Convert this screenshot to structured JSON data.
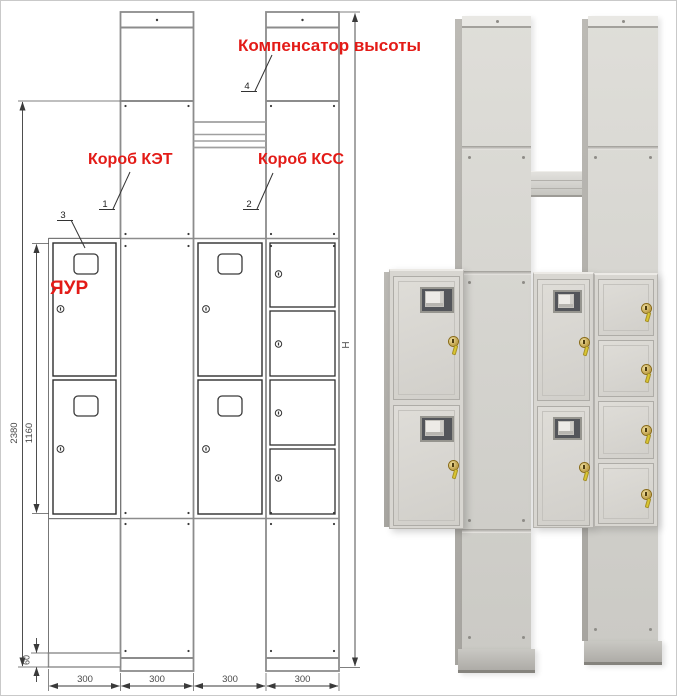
{
  "drawing": {
    "red_labels": {
      "kompensator": "Компенсатор высоты",
      "korob_ket": "Короб КЭТ",
      "korob_kss": "Короб КСС",
      "yaur": "ЯУР"
    },
    "callouts": {
      "ket": "1",
      "kss": "2",
      "yaur": "3",
      "compensator": "4"
    },
    "dimensions": {
      "overall_left": "2380",
      "cabinet_block": "1160",
      "base": "60",
      "height_symbol": "Н",
      "column_widths": [
        "300",
        "300",
        "300",
        "300"
      ]
    }
  },
  "colors": {
    "label_red": "#e31b17",
    "drawing_line_gray": "#8c8c8c",
    "drawing_line_dark": "#2e2e2e",
    "dimension_text": "#4a4a4a",
    "photo_body": "#d6d5d0",
    "photo_side_shadow": "#aeaca7",
    "lock_gold": "#c2a23c",
    "key_yellow": "#d9c530",
    "window_dark": "#53555a"
  }
}
